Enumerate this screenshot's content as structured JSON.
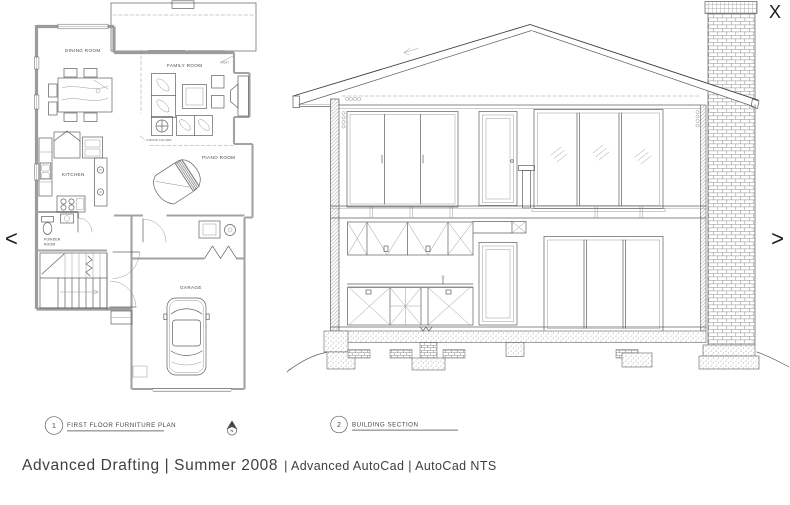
{
  "viewer": {
    "close_label": "X",
    "prev_label": "<",
    "next_label": ">",
    "caption_primary": "Advanced Drafting | Summer 2008",
    "caption_secondary": "| Advanced AutoCad | AutoCad NTS"
  },
  "colors": {
    "background": "#ffffff",
    "line": "#606060",
    "wall_poche": "#9b9b9b",
    "text": "#3f3f3f",
    "brick": "#8a8a8a"
  },
  "floor_plan": {
    "number": "1",
    "title": "FIRST FLOOR FURNITURE PLAN",
    "north_label": "N",
    "rooms": {
      "dining": "DINING ROOM",
      "family": "FAMILY ROOM",
      "kitchen": "KITCHEN",
      "powder_line1": "POWDER",
      "powder_line2": "ROOM",
      "piano": "PIANO ROOM",
      "garage": "GARAGE"
    },
    "annotations": {
      "post": "POST",
      "wood_column": "4 WOOD COLUMN"
    }
  },
  "building_section": {
    "number": "2",
    "title": "BUILDING SECTION"
  }
}
